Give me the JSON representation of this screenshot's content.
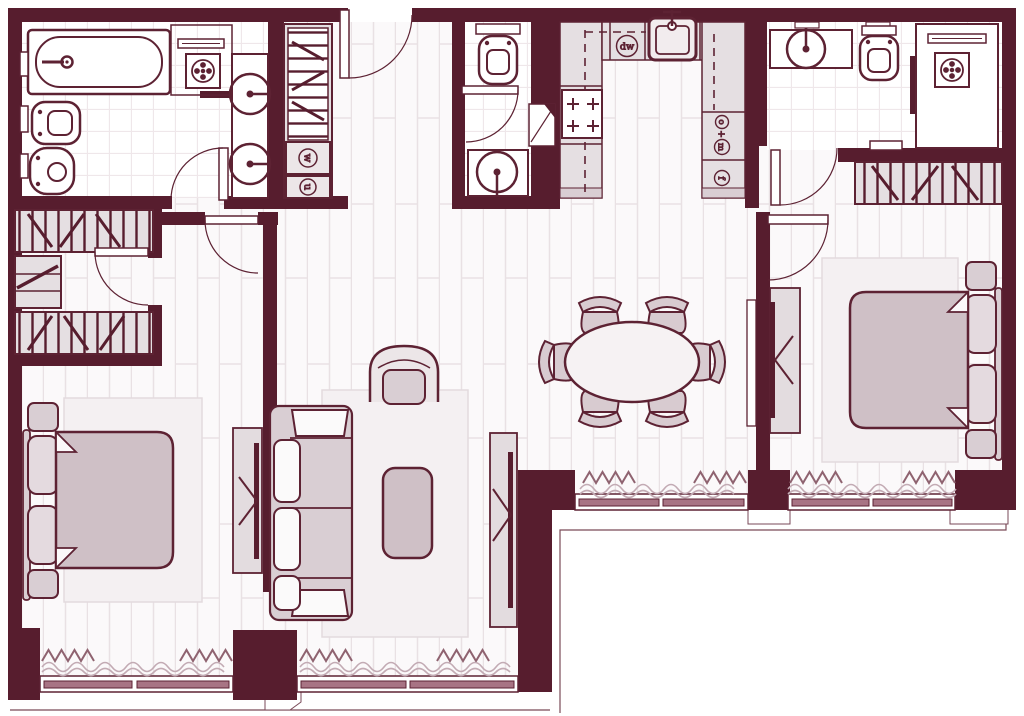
{
  "plan": {
    "type": "apartment-floor-plan",
    "appliance_labels": {
      "dishwasher": "dw",
      "washer": "w",
      "dryer": "u",
      "oven": "o",
      "plus": "+",
      "microwave": "m",
      "fridge": "f"
    },
    "fixture_counts": {
      "dining_chairs": 6,
      "beds": 2,
      "sofas": 1,
      "armchairs": 1,
      "bathtubs": 1,
      "showers": 2,
      "toilets": 3,
      "bidets": 1,
      "sinks": 5
    }
  },
  "palette": {
    "wall": "#571d2e",
    "outline": "#5d2233",
    "floor": "#fbf9fa",
    "plank_line": "#e9e1e4",
    "tile_line": "#efe7ea",
    "cabinet": "#e5dfe2",
    "furniture": "#d9ced3",
    "mauve": "#cfc0c6",
    "cushion": "#fbfafa",
    "rug": "#f4f0f2",
    "window_sash": "#a87484",
    "curtain_zigzag": "#8f6370",
    "curtain_wave": "#c3abb4"
  }
}
